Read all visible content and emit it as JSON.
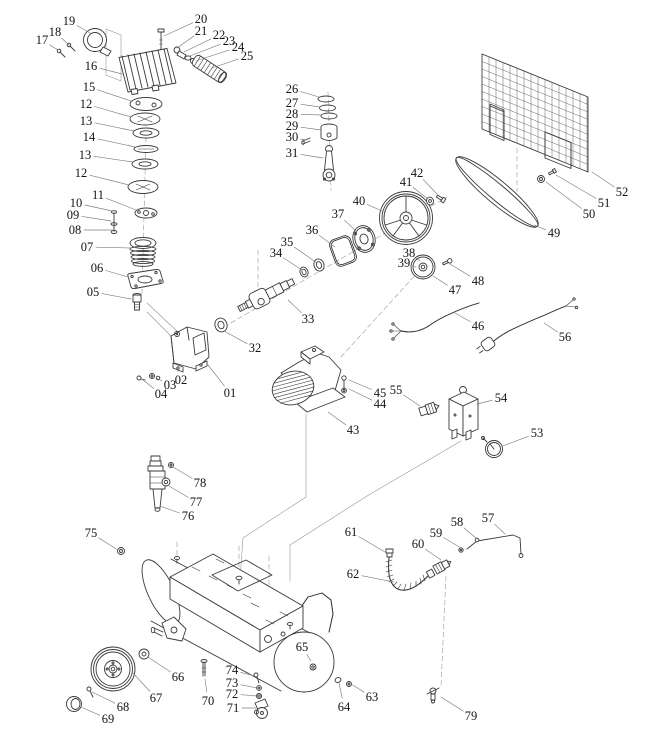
{
  "figure": {
    "type": "exploded-parts-diagram",
    "subject": "air compressor assembly",
    "background": "#ffffff",
    "line_color": "#3a3a3a",
    "label_color": "#141414",
    "leader_color": "#7d7d7d"
  },
  "part_labels": [
    {
      "num": "01",
      "x": 230,
      "y": 393,
      "tx": 208,
      "ty": 365
    },
    {
      "num": "02",
      "x": 181,
      "y": 380,
      "tx": 177,
      "ty": 369
    },
    {
      "num": "03",
      "x": 170,
      "y": 385,
      "tx": 156,
      "ty": 378
    },
    {
      "num": "04",
      "x": 161,
      "y": 394,
      "tx": 143,
      "ty": 380
    },
    {
      "num": "05",
      "x": 93,
      "y": 292,
      "tx": 131,
      "ty": 299
    },
    {
      "num": "06",
      "x": 97,
      "y": 268,
      "tx": 128,
      "ty": 277
    },
    {
      "num": "07",
      "x": 87,
      "y": 247,
      "tx": 131,
      "ty": 248
    },
    {
      "num": "08",
      "x": 75,
      "y": 230,
      "tx": 112,
      "ty": 230
    },
    {
      "num": "09",
      "x": 73,
      "y": 215,
      "tx": 111,
      "ty": 221
    },
    {
      "num": "10",
      "x": 76,
      "y": 203,
      "tx": 112,
      "ty": 211
    },
    {
      "num": "11",
      "x": 98,
      "y": 195,
      "tx": 136,
      "ty": 210
    },
    {
      "num": "12",
      "x": 86,
      "y": 104,
      "tx": 131,
      "ty": 117
    },
    {
      "num": "13",
      "x": 86,
      "y": 121,
      "tx": 134,
      "ty": 131
    },
    {
      "num": "14",
      "x": 89,
      "y": 137,
      "tx": 135,
      "ty": 147
    },
    {
      "num": "13",
      "x": 85,
      "y": 155,
      "tx": 133,
      "ty": 162
    },
    {
      "num": "12",
      "x": 81,
      "y": 173,
      "tx": 129,
      "ty": 185
    },
    {
      "num": "15",
      "x": 89,
      "y": 87,
      "tx": 131,
      "ty": 101
    },
    {
      "num": "16",
      "x": 91,
      "y": 66,
      "tx": 122,
      "ty": 74
    },
    {
      "num": "17",
      "x": 42,
      "y": 40,
      "tx": 58,
      "ty": 50
    },
    {
      "num": "18",
      "x": 55,
      "y": 32,
      "tx": 70,
      "ty": 46
    },
    {
      "num": "19",
      "x": 69,
      "y": 21,
      "tx": 90,
      "ty": 33
    },
    {
      "num": "20",
      "x": 201,
      "y": 19,
      "tx": 164,
      "ty": 36
    },
    {
      "num": "21",
      "x": 201,
      "y": 31,
      "tx": 177,
      "ty": 48
    },
    {
      "num": "22",
      "x": 219,
      "y": 35,
      "tx": 184,
      "ty": 52
    },
    {
      "num": "23",
      "x": 229,
      "y": 41,
      "tx": 190,
      "ty": 56
    },
    {
      "num": "24",
      "x": 238,
      "y": 47,
      "tx": 196,
      "ty": 61
    },
    {
      "num": "25",
      "x": 247,
      "y": 56,
      "tx": 212,
      "ty": 68
    },
    {
      "num": "26",
      "x": 292,
      "y": 89,
      "tx": 319,
      "ty": 97
    },
    {
      "num": "27",
      "x": 292,
      "y": 103,
      "tx": 320,
      "ty": 107
    },
    {
      "num": "28",
      "x": 292,
      "y": 114,
      "tx": 321,
      "ty": 115
    },
    {
      "num": "29",
      "x": 292,
      "y": 126,
      "tx": 321,
      "ty": 130
    },
    {
      "num": "30",
      "x": 292,
      "y": 137,
      "tx": 305,
      "ty": 140
    },
    {
      "num": "31",
      "x": 292,
      "y": 153,
      "tx": 323,
      "ty": 158
    },
    {
      "num": "32",
      "x": 255,
      "y": 348,
      "tx": 224,
      "ty": 331
    },
    {
      "num": "33",
      "x": 308,
      "y": 319,
      "tx": 288,
      "ty": 300
    },
    {
      "num": "34",
      "x": 276,
      "y": 253,
      "tx": 302,
      "ty": 270
    },
    {
      "num": "35",
      "x": 287,
      "y": 242,
      "tx": 317,
      "ty": 263
    },
    {
      "num": "36",
      "x": 312,
      "y": 230,
      "tx": 335,
      "ty": 247
    },
    {
      "num": "37",
      "x": 338,
      "y": 214,
      "tx": 357,
      "ty": 232
    },
    {
      "num": "38",
      "x": 409,
      "y": 253,
      "tx": 420,
      "ty": 261
    },
    {
      "num": "39",
      "x": 404,
      "y": 263,
      "tx": 416,
      "ty": 267
    },
    {
      "num": "40",
      "x": 359,
      "y": 201,
      "tx": 382,
      "ty": 211
    },
    {
      "num": "41",
      "x": 406,
      "y": 182,
      "tx": 428,
      "ty": 199
    },
    {
      "num": "42",
      "x": 417,
      "y": 173,
      "tx": 437,
      "ty": 194
    },
    {
      "num": "43",
      "x": 353,
      "y": 430,
      "tx": 328,
      "ty": 412
    },
    {
      "num": "44",
      "x": 380,
      "y": 404,
      "tx": 349,
      "ty": 389
    },
    {
      "num": "45",
      "x": 380,
      "y": 393,
      "tx": 349,
      "ty": 380
    },
    {
      "num": "46",
      "x": 478,
      "y": 326,
      "tx": 455,
      "ty": 313
    },
    {
      "num": "47",
      "x": 455,
      "y": 290,
      "tx": 433,
      "ty": 276
    },
    {
      "num": "48",
      "x": 478,
      "y": 281,
      "tx": 450,
      "ty": 264
    },
    {
      "num": "49",
      "x": 554,
      "y": 233,
      "tx": 534,
      "ty": 225
    },
    {
      "num": "50",
      "x": 589,
      "y": 214,
      "tx": 546,
      "ty": 182
    },
    {
      "num": "51",
      "x": 604,
      "y": 203,
      "tx": 556,
      "ty": 175
    },
    {
      "num": "52",
      "x": 622,
      "y": 192,
      "tx": 592,
      "ty": 172
    },
    {
      "num": "53",
      "x": 537,
      "y": 433,
      "tx": 503,
      "ty": 446
    },
    {
      "num": "54",
      "x": 501,
      "y": 398,
      "tx": 477,
      "ty": 404
    },
    {
      "num": "55",
      "x": 396,
      "y": 390,
      "tx": 420,
      "ty": 406
    },
    {
      "num": "56",
      "x": 565,
      "y": 337,
      "tx": 544,
      "ty": 323
    },
    {
      "num": "57",
      "x": 488,
      "y": 518,
      "tx": 505,
      "ty": 534
    },
    {
      "num": "58",
      "x": 457,
      "y": 522,
      "tx": 477,
      "ty": 539
    },
    {
      "num": "59",
      "x": 436,
      "y": 533,
      "tx": 461,
      "ty": 548
    },
    {
      "num": "60",
      "x": 418,
      "y": 544,
      "tx": 441,
      "ty": 560
    },
    {
      "num": "61",
      "x": 351,
      "y": 532,
      "tx": 385,
      "ty": 552
    },
    {
      "num": "62",
      "x": 353,
      "y": 574,
      "tx": 394,
      "ty": 582
    },
    {
      "num": "63",
      "x": 372,
      "y": 697,
      "tx": 351,
      "ty": 684
    },
    {
      "num": "64",
      "x": 344,
      "y": 707,
      "tx": 339,
      "ty": 683
    },
    {
      "num": "65",
      "x": 302,
      "y": 647,
      "tx": 311,
      "ty": 661
    },
    {
      "num": "66",
      "x": 178,
      "y": 677,
      "tx": 148,
      "ty": 657
    },
    {
      "num": "67",
      "x": 156,
      "y": 698,
      "tx": 133,
      "ty": 673
    },
    {
      "num": "68",
      "x": 123,
      "y": 707,
      "tx": 92,
      "ty": 692
    },
    {
      "num": "69",
      "x": 108,
      "y": 719,
      "tx": 81,
      "ty": 707
    },
    {
      "num": "70",
      "x": 208,
      "y": 701,
      "tx": 205,
      "ty": 679
    },
    {
      "num": "71",
      "x": 233,
      "y": 708,
      "tx": 256,
      "ty": 708
    },
    {
      "num": "72",
      "x": 232,
      "y": 694,
      "tx": 257,
      "ty": 696
    },
    {
      "num": "73",
      "x": 232,
      "y": 683,
      "tx": 257,
      "ty": 688
    },
    {
      "num": "74",
      "x": 232,
      "y": 670,
      "tx": 255,
      "ty": 676
    },
    {
      "num": "75",
      "x": 91,
      "y": 533,
      "tx": 118,
      "ty": 550
    },
    {
      "num": "76",
      "x": 188,
      "y": 516,
      "tx": 160,
      "ty": 506
    },
    {
      "num": "77",
      "x": 196,
      "y": 502,
      "tx": 169,
      "ty": 486
    },
    {
      "num": "78",
      "x": 200,
      "y": 483,
      "tx": 173,
      "ty": 467
    },
    {
      "num": "79",
      "x": 471,
      "y": 716,
      "tx": 441,
      "ty": 697
    }
  ]
}
